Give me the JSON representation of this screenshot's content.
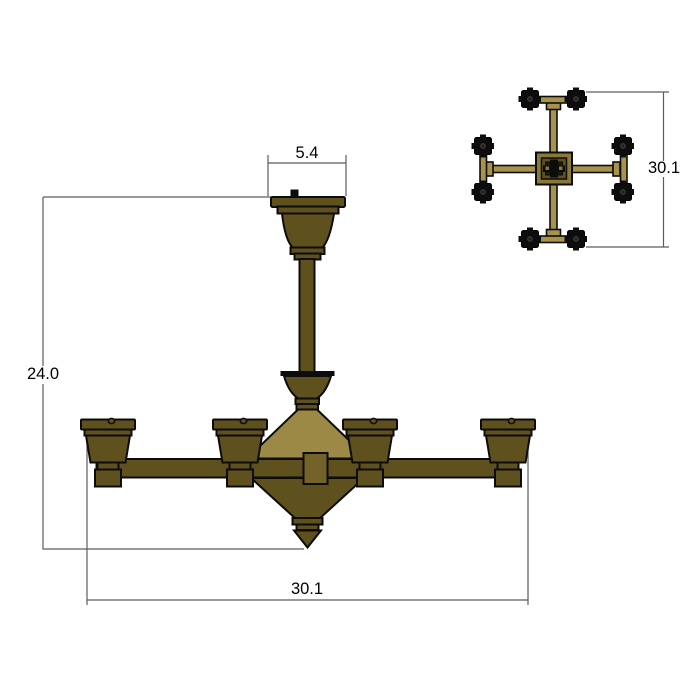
{
  "drawing": {
    "title": "Chandelier dimensioned drawing",
    "views": [
      "front elevation",
      "top plan"
    ]
  },
  "dimensions": {
    "canopy_width": "5.4",
    "overall_height": "24.0",
    "overall_width": "30.1",
    "top_view_overall": "30.1"
  },
  "colors": {
    "brass_dark": "#5e511e",
    "brass_light": "#9c8945",
    "brass_gold": "#a8934d",
    "outline": "#0c0c0c",
    "shade_black": "#0d0d0d",
    "dimension_line": "#5c5c5c",
    "dimension_text": "#000000",
    "background": "#ffffff"
  }
}
